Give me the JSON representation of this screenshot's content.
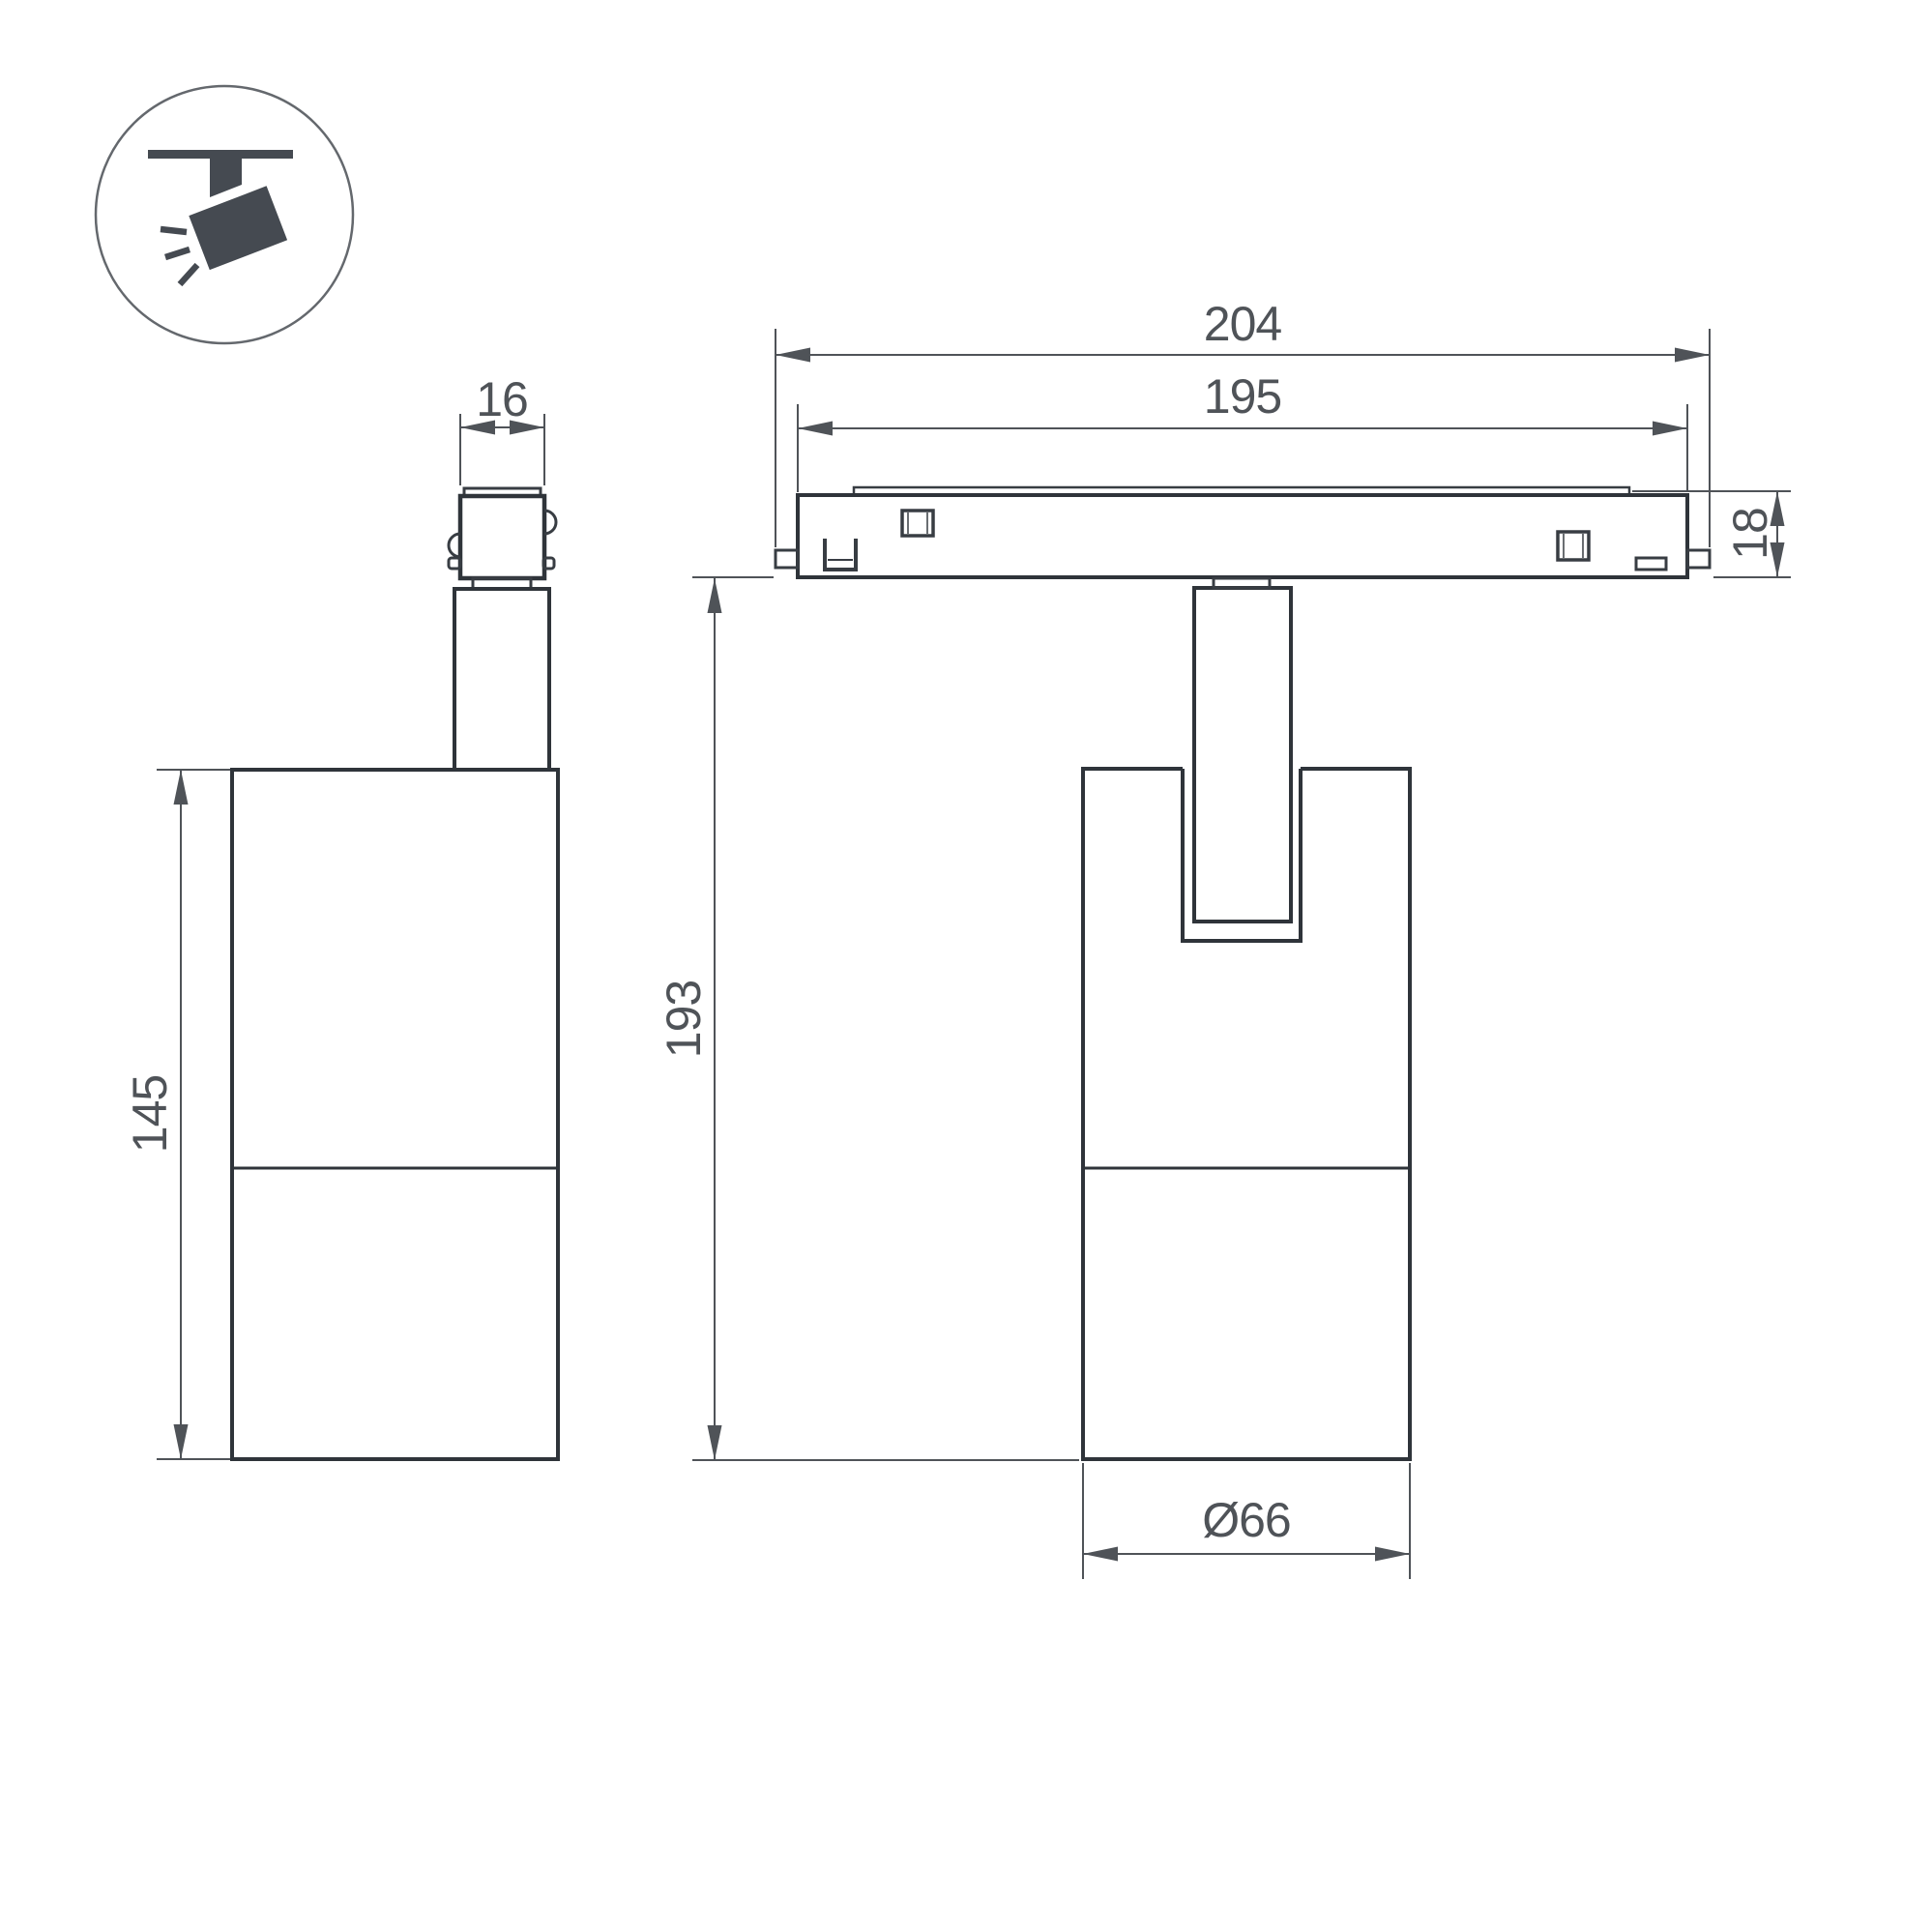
{
  "drawing": {
    "type": "luminaire dimension drawing",
    "units": "mm",
    "views": {
      "side_view": "side view of spotlight with track adapter",
      "front_view": "front view of spotlight on track rail"
    },
    "icon": {
      "name": "ceiling-track-spotlight-pictogram"
    },
    "dimensions": {
      "overall_length": "204",
      "rail_length": "195",
      "rail_height": "18",
      "adapter_width": "16",
      "body_height": "145",
      "mount_height": "193",
      "body_diameter": "Ø66"
    },
    "colors": {
      "object_line": "#2f343a",
      "dimension_line": "#4f5358",
      "icon_fill": "#454a51",
      "background": "#ffffff"
    }
  }
}
